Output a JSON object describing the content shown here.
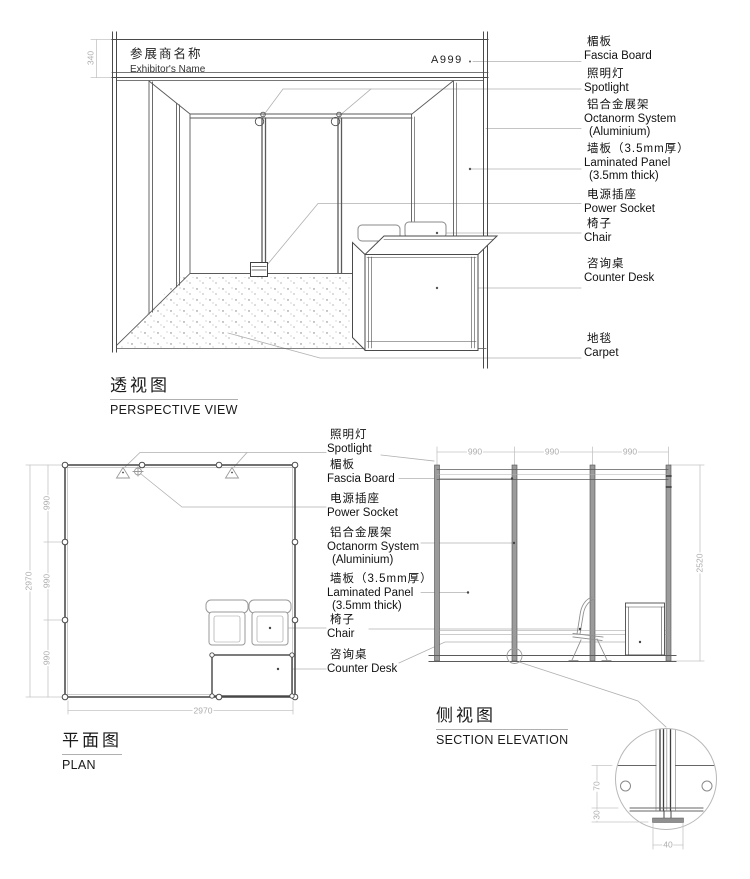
{
  "doc": {
    "titles": {
      "perspective_zh": "透视图",
      "perspective_en": "PERSPECTIVE VIEW",
      "plan_zh": "平面图",
      "plan_en": "PLAN",
      "section_zh": "侧视图",
      "section_en": "SECTION ELEVATION"
    },
    "fascia": {
      "exhibitor_zh": "参展商名称",
      "exhibitor_en": "Exhibitor's Name",
      "booth_no": "A999"
    },
    "labels_right": [
      {
        "zh": "楣板",
        "en": "Fascia Board"
      },
      {
        "zh": "照明灯",
        "en": "Spotlight"
      },
      {
        "zh": "铝合金展架",
        "en": "Octanorm System",
        "en2": "(Aluminium)"
      },
      {
        "zh": "墙板（3.5mm厚）",
        "en": "Laminated Panel",
        "en2": "(3.5mm thick)"
      },
      {
        "zh": "电源插座",
        "en": "Power Socket"
      },
      {
        "zh": "椅子",
        "en": "Chair"
      },
      {
        "zh": "咨询桌",
        "en": "Counter Desk"
      },
      {
        "zh": "地毯",
        "en": "Carpet"
      }
    ],
    "labels_mid": [
      {
        "zh": "照明灯",
        "en": "Spotlight"
      },
      {
        "zh": "楣板",
        "en": "Fascia Board"
      },
      {
        "zh": "电源插座",
        "en": "Power Socket"
      },
      {
        "zh": "铝合金展架",
        "en": "Octanorm System",
        "en2": "(Aluminium)"
      },
      {
        "zh": "墙板（3.5mm厚）",
        "en": "Laminated Panel",
        "en2": "(3.5mm thick)"
      },
      {
        "zh": "椅子",
        "en": "Chair"
      },
      {
        "zh": "咨询桌",
        "en": "Counter Desk"
      }
    ],
    "dims": {
      "fascia_height": "340",
      "plan_bay_1": "990",
      "plan_bay_2": "990",
      "plan_bay_3": "990",
      "plan_total_left": "2970",
      "plan_total_bottom": "2970",
      "sec_bay_1": "990",
      "sec_bay_2": "990",
      "sec_bay_3": "990",
      "sec_height": "2520",
      "detail_upper": "70",
      "detail_lower": "30",
      "detail_base_width": "40"
    }
  }
}
